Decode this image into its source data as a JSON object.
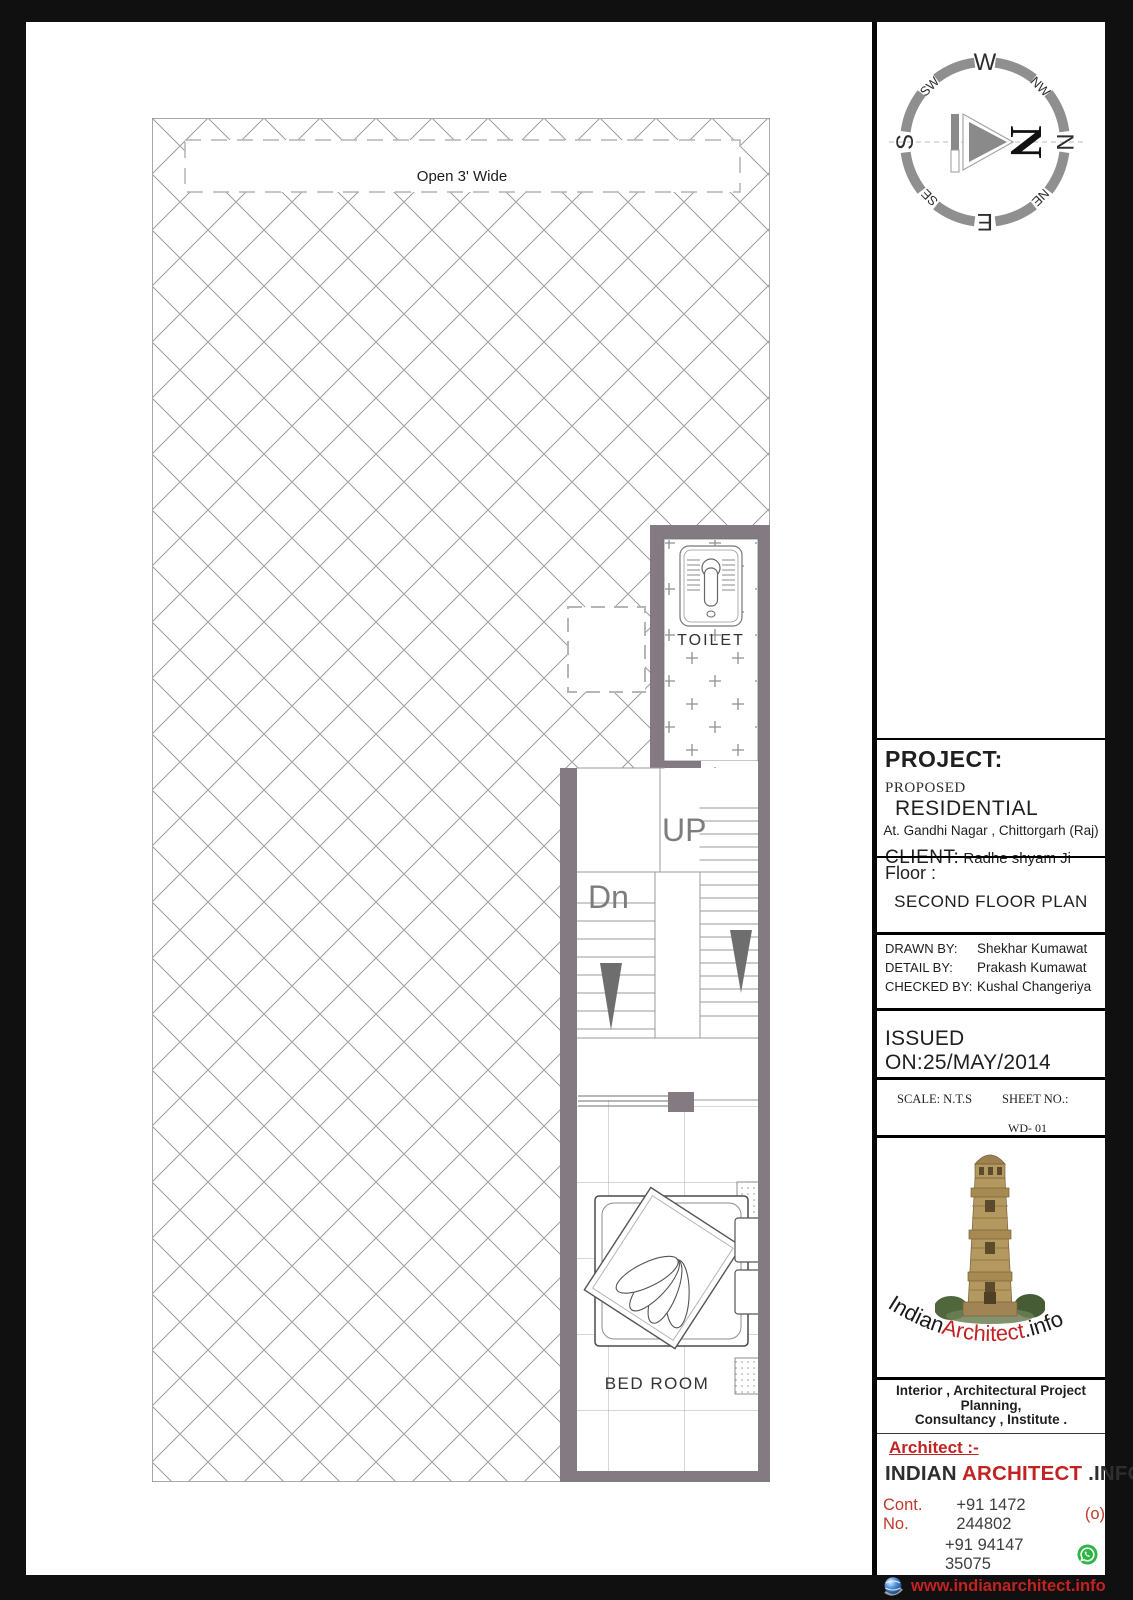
{
  "plan": {
    "open_label": "Open 3' Wide",
    "toilet_label": "TOILET",
    "up_label": "UP",
    "dn_label": "Dn",
    "bedroom_label": "BED ROOM"
  },
  "compass": {
    "big_n": "N",
    "labels": [
      "N",
      "NE",
      "E",
      "SE",
      "S",
      "SW",
      "W",
      "NW"
    ]
  },
  "title_block": {
    "project_heading": "PROJECT:",
    "proposed_label": "PROPOSED",
    "project_type": "RESIDENTIAL",
    "address": "At. Gandhi Nagar , Chittorgarh (Raj)",
    "client_label": "CLIENT:",
    "client_name": "Radhe shyam Ji",
    "floor_label": "Floor :",
    "floor_name": "SECOND FLOOR PLAN",
    "drawn_by_label": "DRAWN BY:",
    "drawn_by": "Shekhar Kumawat",
    "detail_by_label": "DETAIL BY:",
    "detail_by": "Prakash Kumawat",
    "checked_by_label": "CHECKED BY:",
    "checked_by": "Kushal Changeriya",
    "issued_on_label": "ISSUED ON:",
    "issued_on": "25/MAY/2014",
    "scale_label": "SCALE: N.T.S",
    "sheet_no_label": "SHEET NO.:",
    "sheet_no": "WD- 01"
  },
  "branding": {
    "logo_text_part1": "Indian",
    "logo_text_part2": "Architect",
    "logo_text_part3": ".info",
    "tagline_line1": "Interior , Architectural Project Planning,",
    "tagline_line2": "Consultancy , Institute .",
    "architect_label": "Architect :-",
    "firm_part1": "INDIAN",
    "firm_part2": "ARCHITECT",
    "firm_part3": ".INFO",
    "contact_label": "Cont. No.",
    "phone1": "+91 1472 244802",
    "phone1_suffix": "(o)",
    "phone2": "+91 94147 35075",
    "website": "www.indianarchitect.info",
    "email": "info@.indianarchitect.info"
  },
  "colors": {
    "wall": "#847a81",
    "accent_red": "#c32222",
    "whatsapp_green": "#2cb742",
    "hatch_gray": "#9d9d9d"
  }
}
